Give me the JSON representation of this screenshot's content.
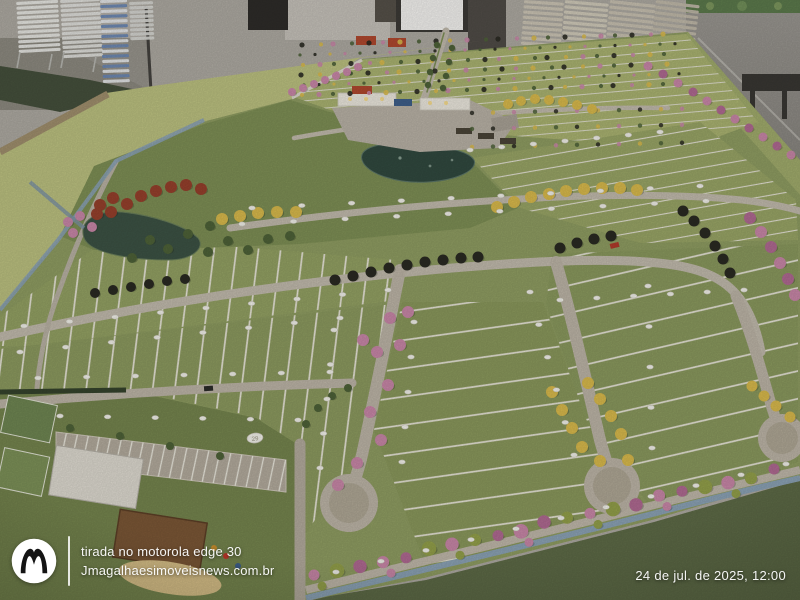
{
  "photo": {
    "subject_label": "maquete-loteamento",
    "environment_label": "showroom-cadeiras-empilhadas"
  },
  "watermark": {
    "logo_name": "motorola-logo",
    "line1": "tirada no motorola edge 30",
    "line2": "Jmagalhaesimoveisnews.com.br"
  },
  "timestamp": {
    "text": "24 de jul. de 2025, 12:00"
  },
  "model_labels": {
    "lot_marker_number": "29"
  },
  "palette": {
    "turf_light": "#bcc180",
    "turf_mid": "#8f9d62",
    "turf_dark": "#5e6b47",
    "road": "#c2bbad",
    "street": "#bdb5a7",
    "water_lake": "#31493f",
    "water_pond": "#3c5244",
    "edge_blue": "#8ba2b5",
    "tree_yellow": "#d9ba4c",
    "tree_pink": "#c987a8",
    "tree_magenta": "#b06a92",
    "tree_dark": "#2a2a22",
    "tree_green": "#4e6238",
    "tree_olive": "#93a04a",
    "tree_red": "#96402c",
    "wall_gray": "#908d87"
  }
}
